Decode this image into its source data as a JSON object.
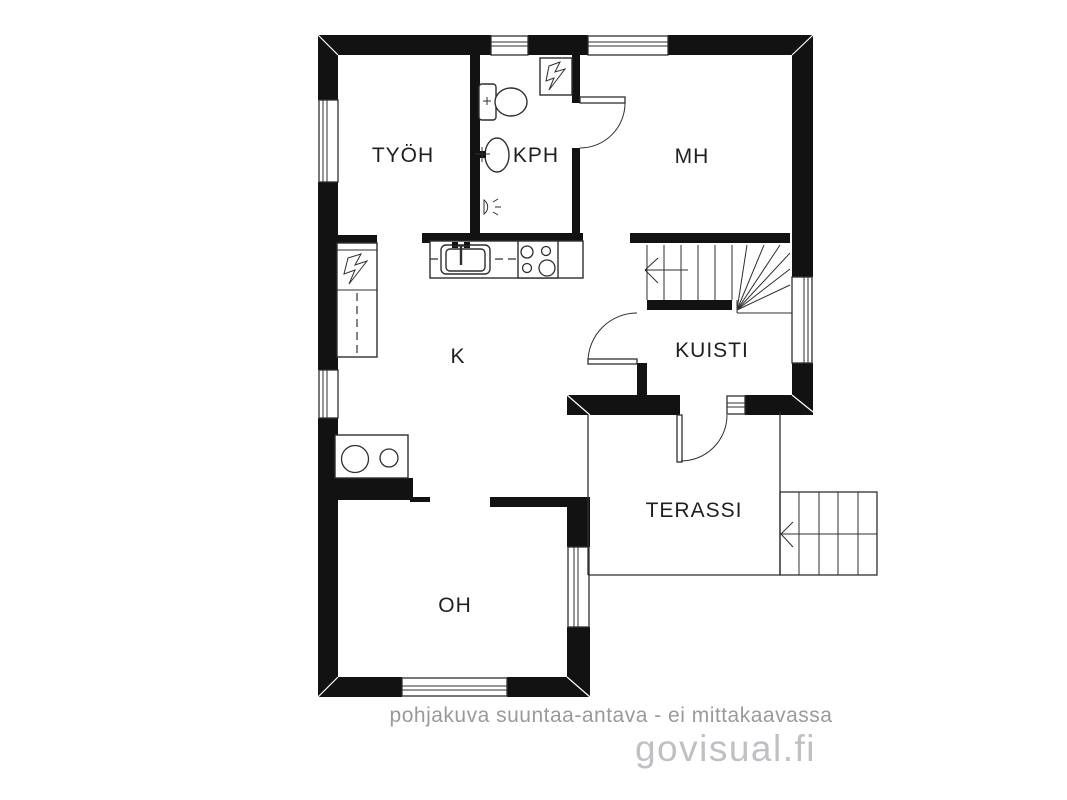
{
  "title": "floor-plan",
  "rooms": {
    "tyoh": {
      "label": "TYÖH"
    },
    "kph": {
      "label": "KPH"
    },
    "mh": {
      "label": "MH"
    },
    "k": {
      "label": "K"
    },
    "kuisti": {
      "label": "KUISTI"
    },
    "terassi": {
      "label": "TERASSI"
    },
    "oh": {
      "label": "OH"
    }
  },
  "watermark": {
    "disclaimer": "pohjakuva suuntaa-antava - ei mittakaavassa",
    "brand": "govisual.fi"
  },
  "icons": [
    "lightning-bolt-icon",
    "toilet-icon",
    "sink-icon",
    "stove-icon",
    "wall-lamp-icon",
    "stair-arrow-icon"
  ],
  "colors": {
    "wall": "#121212",
    "line": "#2f2f2f",
    "ink": "#1f1f1f",
    "muted": "#9a9a9a",
    "brand": "#bfc0c4",
    "bg": "#ffffff"
  }
}
